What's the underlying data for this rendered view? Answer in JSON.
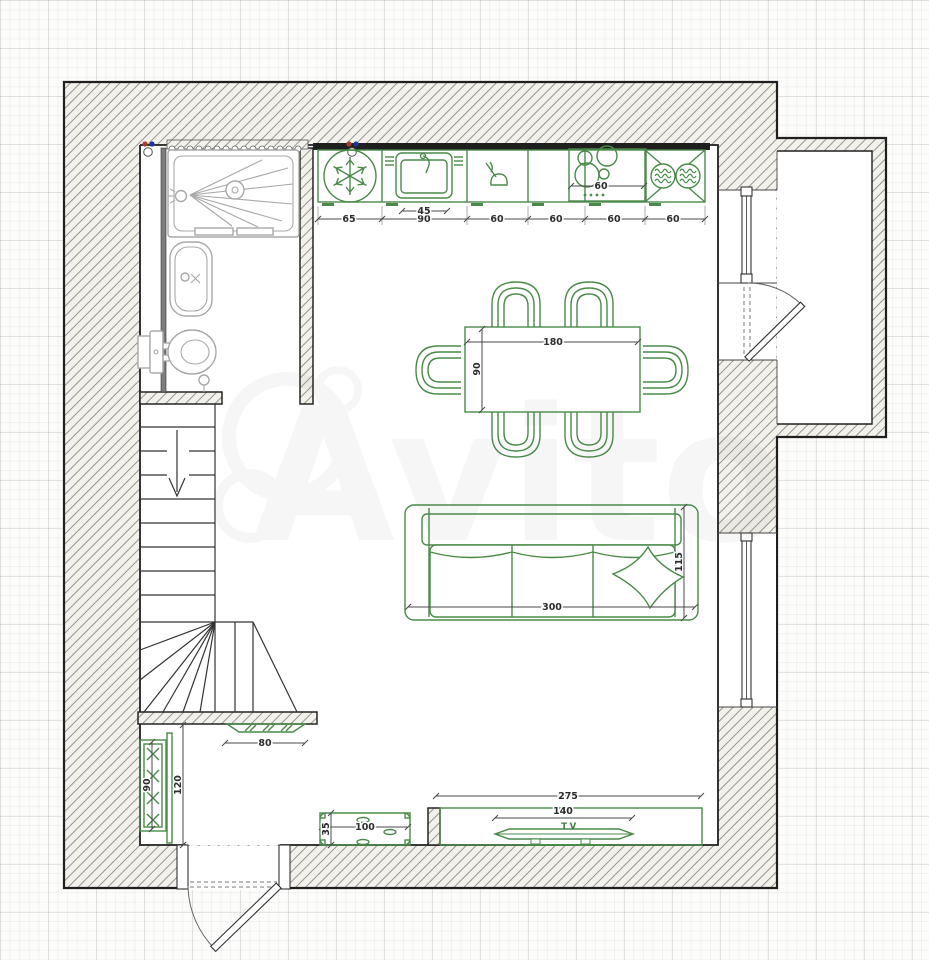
{
  "watermark": {
    "brand": "Avito"
  },
  "palette": {
    "furniture_green": "#4a8a49",
    "fixture_gray": "#a8a8a8",
    "wall_black": "#1f1f1f",
    "dim_text": "#2d2d2d",
    "hot_water_dot": "#b03a2e",
    "cold_water_dot": "#16399a"
  },
  "dims": {
    "kitchen": {
      "unit_widths": [
        "65",
        "90",
        "60",
        "60",
        "60",
        "60"
      ],
      "sink_width": "45",
      "cooktop_width": "60"
    },
    "dining_table": {
      "length": "180",
      "width": "90"
    },
    "sofa": {
      "length": "300",
      "depth": "115"
    },
    "tv_area": {
      "niche_width": "275",
      "tv_width": "140",
      "tv_label": "TV"
    },
    "entry": {
      "understair_unit_width": "80",
      "hall_width": "120",
      "wardrobe_width": "90",
      "bench_length": "100",
      "bench_depth": "35"
    }
  }
}
